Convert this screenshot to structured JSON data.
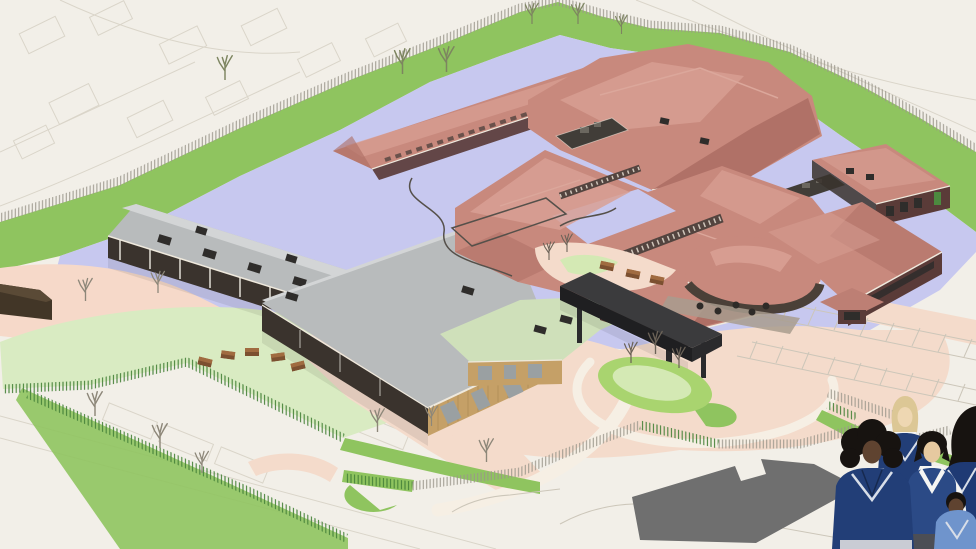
{
  "scene": {
    "type": "architectural-aerial-cgi-rendering",
    "description": "Architect's aerial CGI visualisation of a proposed school campus: red-roofed teaching blocks around courtyards, a grey-roofed sports hall with timber cladding, a black entrance canopy, lavender playground hardstanding, green boundary banks with bare trees, playing field with benches, car parks, and illustrated pupils in navy school uniform in the foreground.",
    "palette": {
      "bg": "#f2efe8",
      "context-line": "#d9d4c8",
      "grass-bright": "#8fc45f",
      "grass-pale": "#d9ebc2",
      "grass-mid": "#a9d46f",
      "grass-island-light": "#d4e9b4",
      "lavender": "#c7c8ef",
      "peach": "#f4dbcb",
      "sand-pink": "#f6d9c9",
      "cream-path": "#f6efe4",
      "roof-red": "#c8897d",
      "roof-red-light": "#d8a094",
      "roof-red-dark": "#ab6d63",
      "roof-ridge": "#dba79b",
      "roof-gray": "#b8bbbc",
      "roof-gray-back": "#d3d5d6",
      "roof-sage": "#cfe0ba",
      "fascia-white": "#efe9dd",
      "wall-dark": "#3a332d",
      "wall-maroon": "#5a3b38",
      "timber": "#c5a067",
      "timber-dark": "#a98853",
      "glazing": "#2f2d2b",
      "window-gray": "#9aa0a2",
      "canopy-top": "#3b3b3d",
      "canopy-side": "#1f1f21",
      "canopy-leg": "#2a2a2c",
      "roof-well": "#413d38",
      "roof-equipment": "#6b675f",
      "terrace": "#a89c8e",
      "table-dark": "#2e2b28",
      "shed-brown": "#423627",
      "footprint-gray": "#6f6f6f",
      "bench-top": "#a06b40",
      "bench-side": "#7c5030",
      "marking-line": "#ccc6b9",
      "fence-green": "#47833a",
      "fence-gray": "#9a968b",
      "tree-gray": "#8d8779",
      "tree-olive": "#7d8560",
      "tree-dark": "#6b6257",
      "clerestory": "#53443f",
      "mullion": "#cfc5ba",
      "court-fence": "#55504a",
      "door-green": "#4c8a3f",
      "post-light": "#d8d4cb",
      "uniform-navy": "#2b4a86",
      "uniform-navy-dark": "#223e77",
      "uniform-navy-deep": "#1f3a74",
      "uniform-light-blue": "#6f94cc",
      "shirt-white": "#f5f5f3",
      "skin-dark": "#5f4330",
      "skin-light": "#eed7b2",
      "skin-tan": "#e6c9a0",
      "hair-blonde": "#dcc795",
      "hair-black": "#171310",
      "trouser-gray": "#c9ccd4",
      "trouser-dark": "#4c4e55",
      "trim-white": "#d8dee8",
      "tie-navy": "#1d2c52"
    },
    "site": {
      "buildings": [
        "classroom-wing",
        "sports-hall",
        "sage-link-block",
        "entrance-canopy",
        "north-wing",
        "north-block",
        "central-block",
        "entrance-pavilion",
        "east-wing",
        "south-east-block",
        "garden-shed"
      ],
      "landscape": [
        "context-street-plan",
        "boundary-grass-bank",
        "perimeter-fence",
        "playground-hardstanding",
        "playing-field",
        "bench-arc",
        "bare-trees",
        "landscape-island",
        "car-park",
        "parking-bays",
        "existing-building-footprint"
      ],
      "figures": [
        "pupil-left",
        "pupil-blonde-back",
        "pupil-centre",
        "pupil-right-cropped",
        "pupil-small-front"
      ]
    },
    "counts": {
      "pupils": 5,
      "bare_trees": 19,
      "benches": 8,
      "cafe_tables": 5
    }
  }
}
